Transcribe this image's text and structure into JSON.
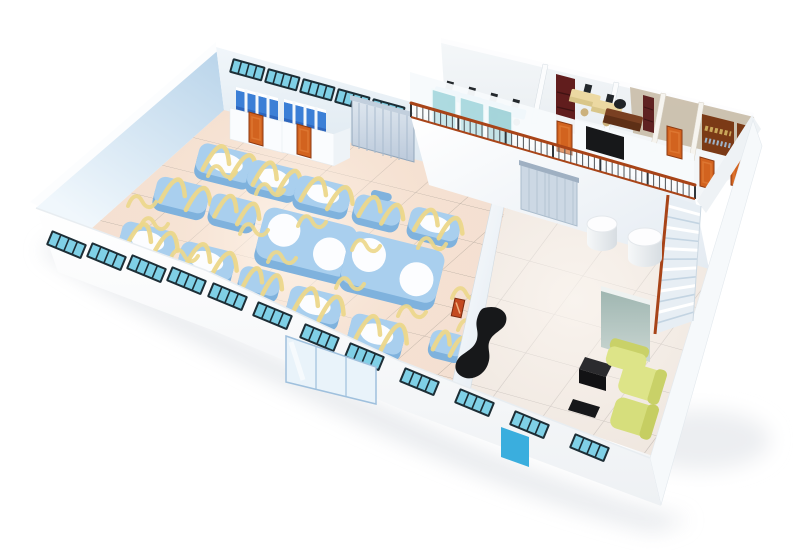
{
  "scene": {
    "title": "3D cutaway floor plan of a factory building with mezzanine offices",
    "style": "isometric cutaway illustration on white background",
    "areas": [
      {
        "name": "production-hall",
        "description": "warm tiled hall filled with rounded blue process machines and yellow hoses"
      },
      {
        "name": "restroom-block",
        "stall_groups": 2,
        "doors": 2
      },
      {
        "name": "roller-door",
        "description": "gray roller shutter on the back wall"
      },
      {
        "name": "mezzanine-offices",
        "rooms": [
          "workstation-office",
          "staff-office",
          "manager-office",
          "archive-room",
          "library-room"
        ],
        "doors": 4
      },
      {
        "name": "mezzanine-railing",
        "description": "wrought-iron railing with rust-brown handrail"
      },
      {
        "name": "staircase",
        "steps": 13
      },
      {
        "name": "reception-lounge",
        "items": [
          "reception-desk",
          "sofa",
          "armchair",
          "side-cabinet",
          "coffee-table",
          "accent-wall",
          "round-tables"
        ]
      }
    ],
    "counts": {
      "front_windows": 12,
      "back_windows": 5,
      "machines": 13,
      "machine_slabs": 2,
      "round_tables": 2,
      "orange_doors": 6,
      "glass_entrance_panels": 3,
      "blue_service_doors": 1
    }
  },
  "colors": {
    "machine_face": "#a9cfee",
    "machine_side": "#7fb2dd",
    "hose": "#ecd78a",
    "window_frame": "#1d2e36",
    "window_glass": "#7fd0e6",
    "door_orange": "#d2631f",
    "door_frame": "#8d3a12",
    "stall_blue": "#3b7fd6",
    "stall_blue_dark": "#2d66bd",
    "railing_rust": "#a84418",
    "desk_blue": "#2f9fd8",
    "cream": "#ecd9a2",
    "sofa_green": "#dde488",
    "sofa_green_dark": "#c9d168",
    "black_furniture": "#17181a",
    "wood_brown": "#7b3a16",
    "bookshelf_red": "#611d1d",
    "tan_wall": "#c9bca9",
    "blue_door": "#3aaede",
    "floor_warm": "#f4e0d2",
    "floor_cool": "#ede4dc"
  },
  "machines": [
    {
      "x": 225,
      "y": 166,
      "w": 58,
      "h": 30,
      "type": "vat"
    },
    {
      "x": 273,
      "y": 181,
      "w": 52,
      "h": 28,
      "type": "vat"
    },
    {
      "x": 322,
      "y": 197,
      "w": 56,
      "h": 28,
      "type": "vat"
    },
    {
      "x": 377,
      "y": 213,
      "w": 48,
      "h": 24,
      "type": "handle"
    },
    {
      "x": 434,
      "y": 227,
      "w": 52,
      "h": 26,
      "type": "vat"
    },
    {
      "x": 181,
      "y": 198,
      "w": 54,
      "h": 28,
      "type": "plain"
    },
    {
      "x": 233,
      "y": 213,
      "w": 48,
      "h": 26,
      "type": "plain"
    },
    {
      "x": 147,
      "y": 244,
      "w": 56,
      "h": 30,
      "type": "vat"
    },
    {
      "x": 206,
      "y": 264,
      "w": 56,
      "h": 30,
      "type": "vat"
    },
    {
      "x": 259,
      "y": 284,
      "w": 42,
      "h": 24,
      "type": "plain"
    },
    {
      "x": 314,
      "y": 308,
      "w": 54,
      "h": 30,
      "type": "vat"
    },
    {
      "x": 376,
      "y": 337,
      "w": 56,
      "h": 32,
      "type": "vat"
    },
    {
      "x": 447,
      "y": 346,
      "w": 36,
      "h": 22,
      "type": "plain"
    }
  ],
  "slabs": [
    {
      "x": 306,
      "y": 245,
      "w": 96,
      "h": 52,
      "r": 16.5,
      "dx": 25,
      "dy": 6
    },
    {
      "x": 392,
      "y": 270,
      "w": 98,
      "h": 54,
      "r": 17,
      "dx": 26,
      "dy": 6
    }
  ],
  "floor_hoses": [
    [
      140,
      228
    ],
    [
      170,
      260
    ],
    [
      198,
      294
    ],
    [
      252,
      318
    ],
    [
      306,
      348
    ],
    [
      356,
      374
    ],
    [
      128,
      206
    ],
    [
      298,
      226
    ],
    [
      352,
      250
    ],
    [
      418,
      248
    ],
    [
      452,
      298
    ],
    [
      458,
      330
    ],
    [
      240,
      234
    ],
    [
      268,
      262
    ],
    [
      336,
      288
    ],
    [
      398,
      316
    ],
    [
      208,
      176
    ],
    [
      256,
      194
    ]
  ],
  "front_windows": [
    [
      52,
      230
    ],
    [
      92,
      242
    ],
    [
      132,
      254
    ],
    [
      172,
      266
    ],
    [
      213,
      282
    ],
    [
      258,
      301
    ],
    [
      305,
      323
    ],
    [
      350,
      342
    ],
    [
      405,
      367
    ],
    [
      460,
      388
    ],
    [
      515,
      410
    ],
    [
      575,
      433
    ]
  ],
  "back_windows": [
    [
      233,
      58
    ],
    [
      268,
      68
    ],
    [
      303,
      78
    ],
    [
      338,
      88
    ],
    [
      373,
      98
    ]
  ],
  "railing": {
    "x1": 411,
    "y1": 117,
    "x2": 695,
    "y2": 199,
    "height": 14,
    "balusters": 48
  },
  "stairs": {
    "steps": 13,
    "tl": [
      668,
      195
    ],
    "tr": [
      701,
      206
    ],
    "bl": [
      655,
      334
    ],
    "br": [
      693,
      321
    ]
  }
}
